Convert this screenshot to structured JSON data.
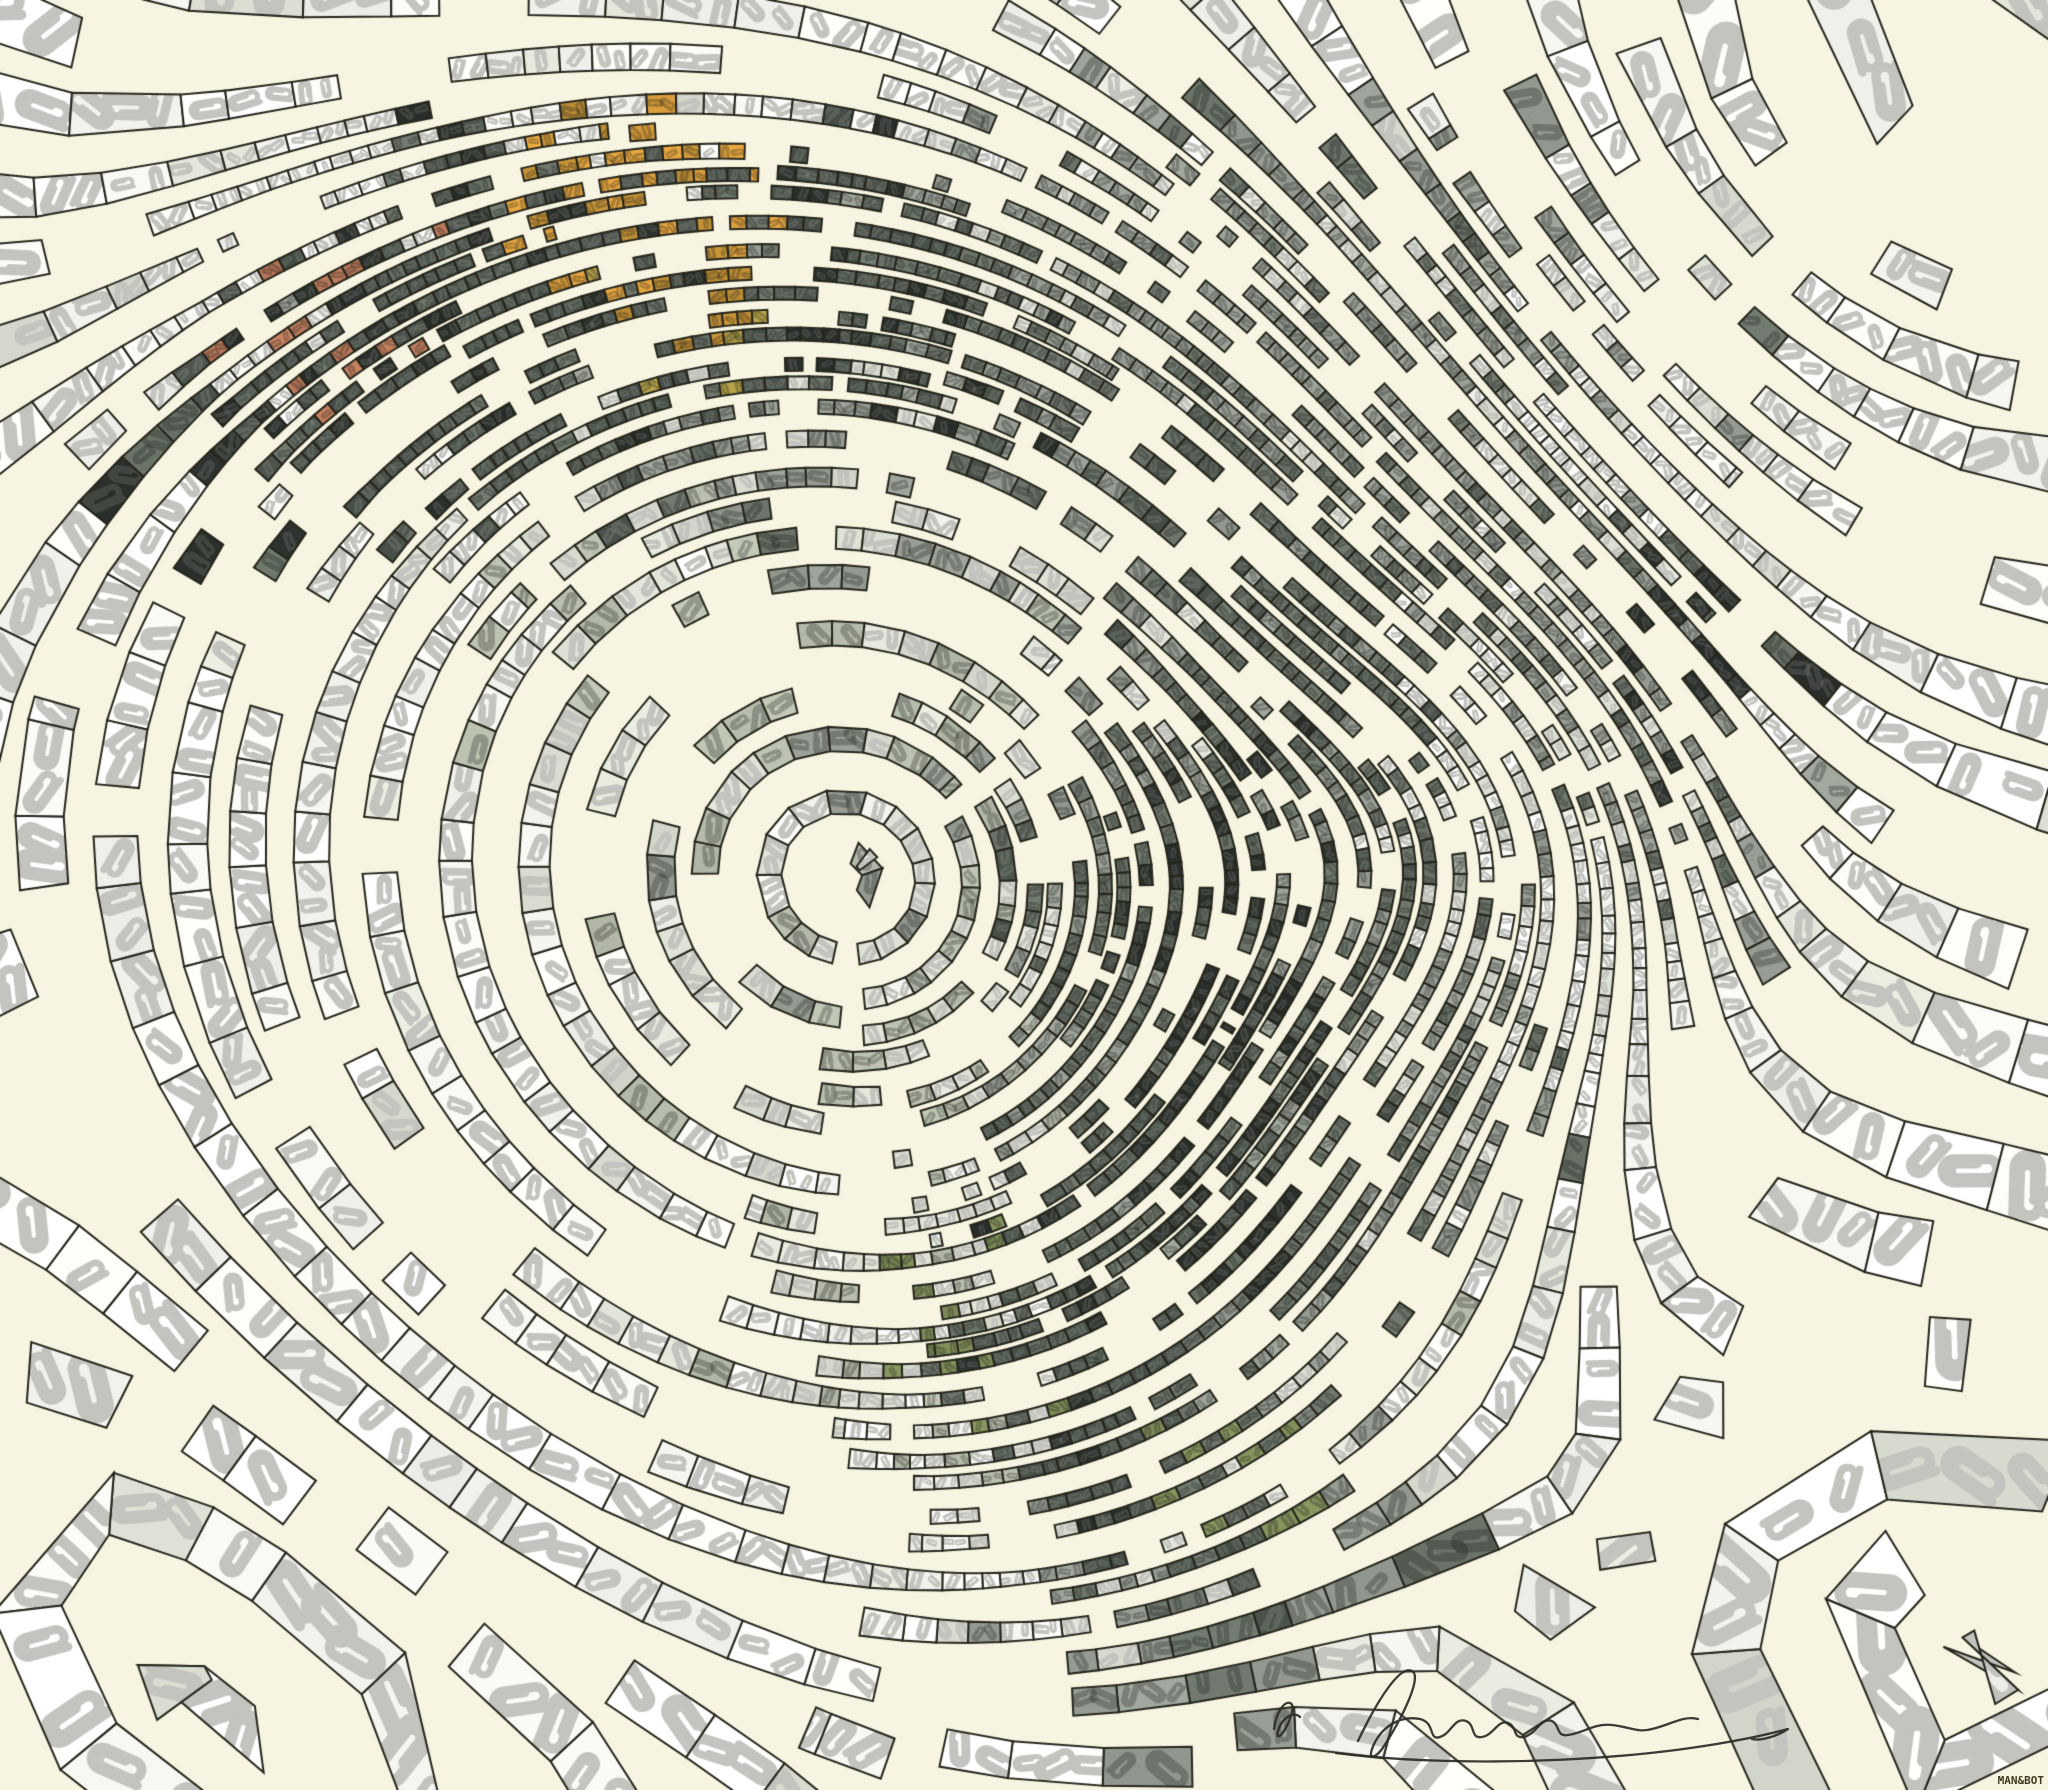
{
  "footer": {
    "credit": "MAN&BOT"
  },
  "signature": {
    "color": "#2b2a25",
    "path_initial": "M34 84 C36 68 44 56 50 58 C56 60 50 76 44 86 C40 92 36 94 38 86 C42 72 54 66 60 72",
    "path_main": "M118 96 C138 54 160 20 172 26 C184 32 156 84 142 104 C136 112 128 116 132 104 C140 82 160 70 180 74 C196 78 188 96 200 92 C212 88 214 72 226 76 C236 80 230 94 242 92 C254 90 258 74 268 78 C278 82 272 94 284 92 C298 88 300 72 312 76 C320 80 316 92 328 90 C344 88 354 78 372 80 C390 82 398 88 412 84 C430 80 444 70 458 74",
    "path_flourish": "M96 108 C220 124 420 118 548 84 C536 92 520 96 512 94"
  },
  "canvas": {
    "width": 2048,
    "height": 1790,
    "background": "#f7f5e1",
    "outline": "#26261d",
    "seed": 7
  },
  "palette": {
    "W": "#fbfbf7",
    "L": "#dfe2d6",
    "S": "#b9bfae",
    "M": "#9aa097",
    "G": "#6e766c",
    "D": "#49514a",
    "K": "#2b302c",
    "O": "#dfa13e",
    "A": "#c49238",
    "Y": "#b5a24a",
    "R": "#bd7c5c",
    "V": "#83915c",
    "clip_light": "#c3c3bf"
  },
  "color_grid": {
    "cols": 16,
    "rows": 14,
    "rows_data": [
      "WWWWWWWWWWWWWWWW",
      "WWWDOODMMMMMWWWW",
      "WWRDDADDMMMMWMWW",
      "WKDDDMMMGGMMWWWW",
      "WWWWLLMLMGGMMKWW",
      "WWWWLLSSMGGWMKWW",
      "WWWWLSLSGKGWMMWW",
      "WWWWWLSLGKGMWWWW",
      "WWWWWLLSGKGMWWWW",
      "WWWWWWLLDKGMWWWW",
      "WWWWWWLVDGMLWWWW",
      "WWWWWWWLDVMWWWWW",
      "WWWWWWWWMGMWWWWW",
      "WWWWWWWWWMWWWWWW"
    ]
  },
  "mixtures": {
    "W": [
      [
        "W",
        0.9
      ],
      [
        "L",
        0.1
      ]
    ],
    "L": [
      [
        "L",
        0.6
      ],
      [
        "W",
        0.22
      ],
      [
        "S",
        0.18
      ]
    ],
    "S": [
      [
        "S",
        0.55
      ],
      [
        "L",
        0.25
      ],
      [
        "M",
        0.2
      ]
    ],
    "M": [
      [
        "M",
        0.6
      ],
      [
        "G",
        0.16
      ],
      [
        "L",
        0.24
      ]
    ],
    "G": [
      [
        "G",
        0.58
      ],
      [
        "D",
        0.22
      ],
      [
        "M",
        0.2
      ]
    ],
    "D": [
      [
        "D",
        0.62
      ],
      [
        "K",
        0.2
      ],
      [
        "G",
        0.18
      ]
    ],
    "K": [
      [
        "K",
        0.7
      ],
      [
        "D",
        0.2
      ],
      [
        "G",
        0.1
      ]
    ],
    "O": [
      [
        "O",
        0.55
      ],
      [
        "A",
        0.2
      ],
      [
        "D",
        0.15
      ],
      [
        "K",
        0.1
      ]
    ],
    "A": [
      [
        "A",
        0.5
      ],
      [
        "Y",
        0.2
      ],
      [
        "D",
        0.2
      ],
      [
        "M",
        0.1
      ]
    ],
    "R": [
      [
        "R",
        0.5
      ],
      [
        "D",
        0.25
      ],
      [
        "M",
        0.15
      ],
      [
        "K",
        0.1
      ]
    ],
    "V": [
      [
        "V",
        0.45
      ],
      [
        "G",
        0.3
      ],
      [
        "L",
        0.25
      ]
    ],
    "Y": [
      [
        "Y",
        0.6
      ],
      [
        "A",
        0.25
      ],
      [
        "M",
        0.15
      ]
    ]
  },
  "field": {
    "base_angle_deg": 44,
    "vortices": [
      {
        "x": 855,
        "y": 870,
        "a": 5200,
        "s": 400
      },
      {
        "x": 1445,
        "y": 830,
        "a": 900,
        "s": 160
      },
      {
        "x": 230,
        "y": 1640,
        "a": -1100,
        "s": 520
      },
      {
        "x": 1950,
        "y": 60,
        "a": -1500,
        "s": 420
      },
      {
        "x": 2100,
        "y": 1560,
        "a": 1300,
        "s": 430
      }
    ]
  },
  "detail_spots": [
    {
      "x": 1445,
      "y": 830,
      "sx": 210,
      "sy": 210,
      "w": 1.35
    },
    {
      "x": 1000,
      "y": 260,
      "sx": 620,
      "sy": 170,
      "w": 1.0
    },
    {
      "x": 1680,
      "y": 600,
      "sx": 260,
      "sy": 260,
      "w": 0.55
    },
    {
      "x": 1180,
      "y": 1280,
      "sx": 300,
      "sy": 300,
      "w": 0.8
    },
    {
      "x": 1060,
      "y": 1500,
      "sx": 220,
      "sy": 220,
      "w": 0.6
    },
    {
      "x": 880,
      "y": 800,
      "sx": 330,
      "sy": 330,
      "w": 0.45
    },
    {
      "x": 380,
      "y": 340,
      "sx": 200,
      "sy": 200,
      "w": 0.85
    }
  ],
  "periphery": {
    "cx": 850,
    "cy": 760,
    "r0": 620,
    "r1": 700
  },
  "strips": {
    "step": 4,
    "seed_spacing": 24,
    "skip_prob": 0.12,
    "outline_width": 2,
    "lone_tiles": 70
  }
}
